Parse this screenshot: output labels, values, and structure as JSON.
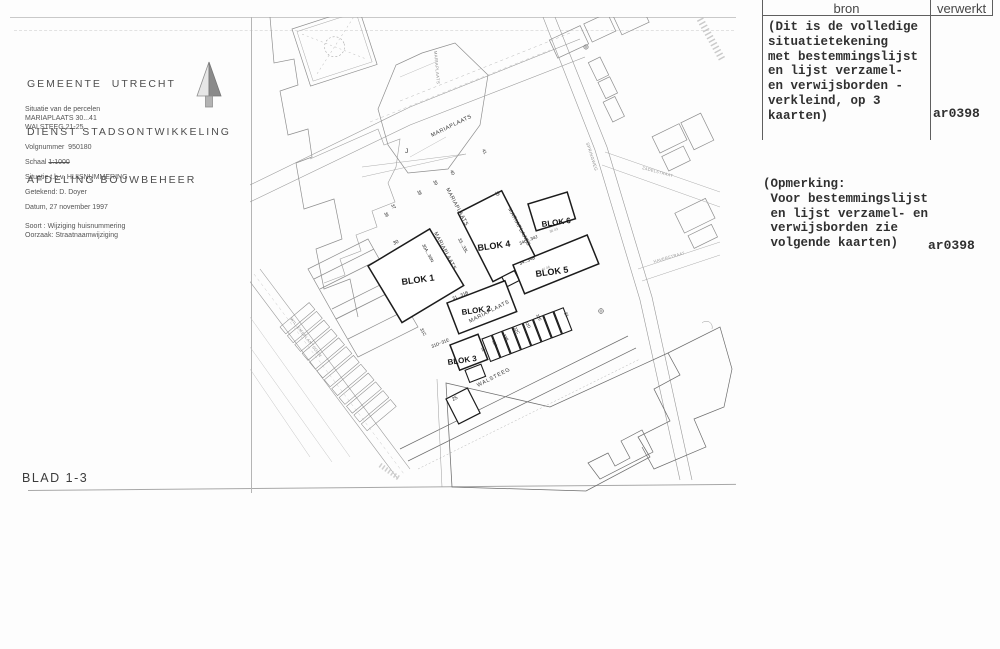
{
  "left_panel": {
    "org": [
      "GEMEENTE  UTRECHT",
      "DIENST STADSONTWIKKELING",
      "AFDELING BOUWBEHEER"
    ],
    "situatie": [
      "Situatie van de percelen",
      "MARIAPLAATS 30...41",
      "WALSTEEG 21-25"
    ],
    "volgnummer": "Volgnummer  950180",
    "schaal_label": "Schaal ",
    "schaal_value": "1:1000",
    "situatie_tbv": "Situatie t.b.v. HUISNUMMERING",
    "getekend": "Getekend: D. Doyer",
    "datum": "Datum, 27 november 1997",
    "soort": "Soort : Wijziging huisnummering",
    "oorzaak": "Oorzaak: Straatnaamwijziging",
    "blad": "BLAD 1-3"
  },
  "icons": {
    "north_arrow": "north-arrow"
  },
  "table": {
    "col_bron": "bron",
    "col_verwerkt": "verwerkt",
    "bron_note": "(Dit is de volledige\nsituatietekening\nmet bestemmingslijst\nen lijst verzamel-\nen verwijsborden -\nverkleind, op 3\nkaarten)",
    "bron_verwerkt": "ar0398",
    "opmerking": "(Opmerking:\n Voor bestemmingslijst\n en lijst verzamel- en\n verwijsborden zie\n volgende kaarten)",
    "opmerking_verwerkt": "ar0398"
  },
  "map": {
    "labels": [
      {
        "t": "BLOK 1",
        "x": 152,
        "y": 268,
        "r": -8,
        "s": 9,
        "w": 600,
        "c": "#161616"
      },
      {
        "t": "BLOK 2",
        "x": 212,
        "y": 298,
        "r": -8,
        "s": 8,
        "w": 600,
        "c": "#161616"
      },
      {
        "t": "BLOK 3",
        "x": 198,
        "y": 348,
        "r": -8,
        "s": 8,
        "w": 600,
        "c": "#161616"
      },
      {
        "t": "BLOK 4",
        "x": 228,
        "y": 234,
        "r": -8,
        "s": 9,
        "w": 600,
        "c": "#161616"
      },
      {
        "t": "BLOK 5",
        "x": 286,
        "y": 260,
        "r": -8,
        "s": 9,
        "w": 600,
        "c": "#161616"
      },
      {
        "t": "BLOK 6",
        "x": 292,
        "y": 210,
        "r": -8,
        "s": 8,
        "w": 600,
        "c": "#161616"
      },
      {
        "t": "MARIAPLAATS",
        "x": 182,
        "y": 120,
        "r": -26,
        "s": 5.5,
        "c": "#333",
        "ls": 0.6
      },
      {
        "t": "MARIAPLAATS",
        "x": 196,
        "y": 172,
        "r": 62,
        "s": 5.3,
        "c": "#333",
        "ls": 0.5
      },
      {
        "t": "MARIAPLAATS",
        "x": 184,
        "y": 216,
        "r": 62,
        "s": 5.3,
        "c": "#333",
        "ls": 0.5
      },
      {
        "t": "MARIAPLAATS",
        "x": 258,
        "y": 192,
        "r": 62,
        "s": 5.3,
        "c": "#333",
        "ls": 0.5
      },
      {
        "t": "MARIAPLAATS",
        "x": 220,
        "y": 306,
        "r": -27,
        "s": 5.5,
        "c": "#333",
        "ls": 0.6
      },
      {
        "t": "MARIAPLAATS",
        "x": 184,
        "y": 34,
        "r": 85,
        "s": 4.2,
        "c": "#888",
        "ls": 0.4
      },
      {
        "t": "WALSTEEG",
        "x": 228,
        "y": 370,
        "r": -27,
        "s": 5.5,
        "c": "#333",
        "ls": 0.8
      },
      {
        "t": "30A...30N",
        "x": 172,
        "y": 228,
        "r": 62,
        "s": 4.5,
        "c": "#222"
      },
      {
        "t": "33...33L",
        "x": 208,
        "y": 222,
        "r": 62,
        "s": 4.5,
        "c": "#222"
      },
      {
        "t": "30",
        "x": 144,
        "y": 228,
        "r": -27,
        "s": 5,
        "c": "#222"
      },
      {
        "t": "31...31B",
        "x": 203,
        "y": 283,
        "r": -22,
        "s": 4.5,
        "c": "#222"
      },
      {
        "t": "34...34B",
        "x": 270,
        "y": 248,
        "r": -22,
        "s": 4.5,
        "c": "#222"
      },
      {
        "t": "34C...34J",
        "x": 270,
        "y": 228,
        "r": -22,
        "s": 4.5,
        "c": "#222"
      },
      {
        "t": "44 46",
        "x": 292,
        "y": 254,
        "r": -22,
        "s": 3.5,
        "c": "#8a8a8a"
      },
      {
        "t": "36 43",
        "x": 300,
        "y": 216,
        "r": -22,
        "s": 3.5,
        "c": "#8a8a8a"
      },
      {
        "t": "31C",
        "x": 170,
        "y": 312,
        "r": 62,
        "s": 4.5,
        "c": "#222"
      },
      {
        "t": "31D~31E",
        "x": 182,
        "y": 331,
        "r": -22,
        "s": 4.5,
        "c": "#222"
      },
      {
        "t": "25",
        "x": 203,
        "y": 384,
        "r": -27,
        "s": 5,
        "c": "#222"
      },
      {
        "t": "21",
        "x": 314,
        "y": 296,
        "r": 62,
        "s": 4.5,
        "c": "#222"
      },
      {
        "t": "32",
        "x": 231,
        "y": 331,
        "r": 62,
        "s": 4,
        "c": "#222"
      },
      {
        "t": "32A",
        "x": 242,
        "y": 324,
        "r": 62,
        "s": 4,
        "c": "#222"
      },
      {
        "t": "32B",
        "x": 253,
        "y": 318,
        "r": 62,
        "s": 4,
        "c": "#222"
      },
      {
        "t": "32C",
        "x": 264,
        "y": 311,
        "r": 62,
        "s": 4,
        "c": "#222"
      },
      {
        "t": "32D",
        "x": 275,
        "y": 305,
        "r": 62,
        "s": 4,
        "c": "#222"
      },
      {
        "t": "32E",
        "x": 286,
        "y": 298,
        "r": 62,
        "s": 4,
        "c": "#222"
      },
      {
        "t": "36",
        "x": 134,
        "y": 196,
        "r": 62,
        "s": 4.5,
        "c": "#222"
      },
      {
        "t": "37",
        "x": 141,
        "y": 188,
        "r": 62,
        "s": 4.5,
        "c": "#222"
      },
      {
        "t": "38",
        "x": 167,
        "y": 174,
        "r": 62,
        "s": 4.5,
        "c": "#222"
      },
      {
        "t": "39",
        "x": 183,
        "y": 164,
        "r": 62,
        "s": 4.5,
        "c": "#222"
      },
      {
        "t": "40",
        "x": 200,
        "y": 154,
        "r": 62,
        "s": 4.5,
        "c": "#222"
      },
      {
        "t": "41",
        "x": 232,
        "y": 133,
        "r": 62,
        "s": 4.5,
        "c": "#222"
      },
      {
        "t": "35",
        "x": 245,
        "y": 175,
        "r": 62,
        "s": 4.5,
        "c": "#222"
      },
      {
        "t": "J",
        "x": 155,
        "y": 136,
        "r": 0,
        "s": 6.5,
        "c": "#333"
      },
      {
        "t": "WILLEMSPLANTSOEN",
        "x": 40,
        "y": 302,
        "r": 52,
        "s": 4,
        "c": "#8a8a8a",
        "ls": 0.4
      },
      {
        "t": "SPRINGWEG",
        "x": 336,
        "y": 126,
        "r": 72,
        "s": 4.2,
        "c": "#8a8a8a",
        "ls": 0.4
      },
      {
        "t": "ZADELSTRAAT",
        "x": 392,
        "y": 152,
        "r": 15,
        "s": 4,
        "c": "#999",
        "ls": 0.3
      },
      {
        "t": "HAVERSTRAAT",
        "x": 404,
        "y": 246,
        "r": -16,
        "s": 4,
        "c": "#999",
        "ls": 0.3
      }
    ]
  }
}
